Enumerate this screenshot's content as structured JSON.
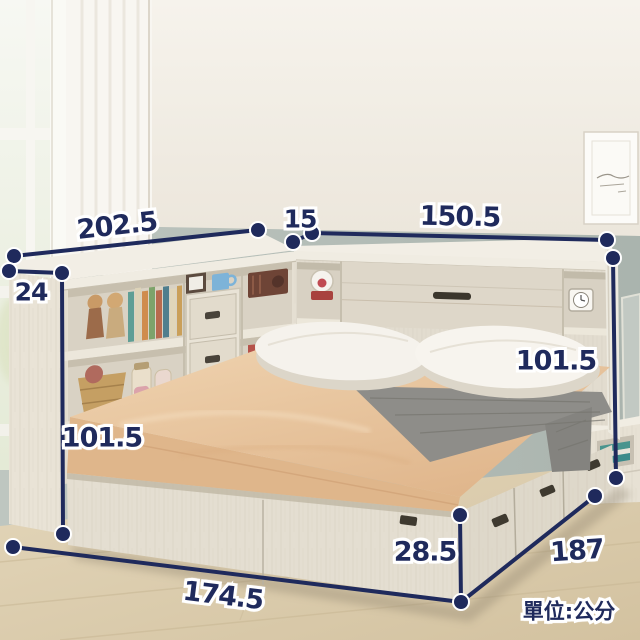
{
  "meta": {
    "unit_label": "單位:公分",
    "image_kind": "bed product dimension diagram"
  },
  "dimensions": {
    "cabinet_width": "202.5",
    "headboard_depth": "15",
    "headboard_width": "150.5",
    "cabinet_depth": "24",
    "cabinet_height": "101.5",
    "headboard_height": "101.5",
    "bed_length": "174.5",
    "base_height": "28.5",
    "bed_width": "187"
  },
  "colors": {
    "dimension": "#1f2a5c",
    "wall_upper": "#f2eee6",
    "wall_lower": "#b6bfb8",
    "floor": "#dccdad",
    "wood": "#e5dfd2",
    "mattress": "#e9c9a4",
    "pillow": "#f5f2ec",
    "throw": "#8e8d89"
  }
}
